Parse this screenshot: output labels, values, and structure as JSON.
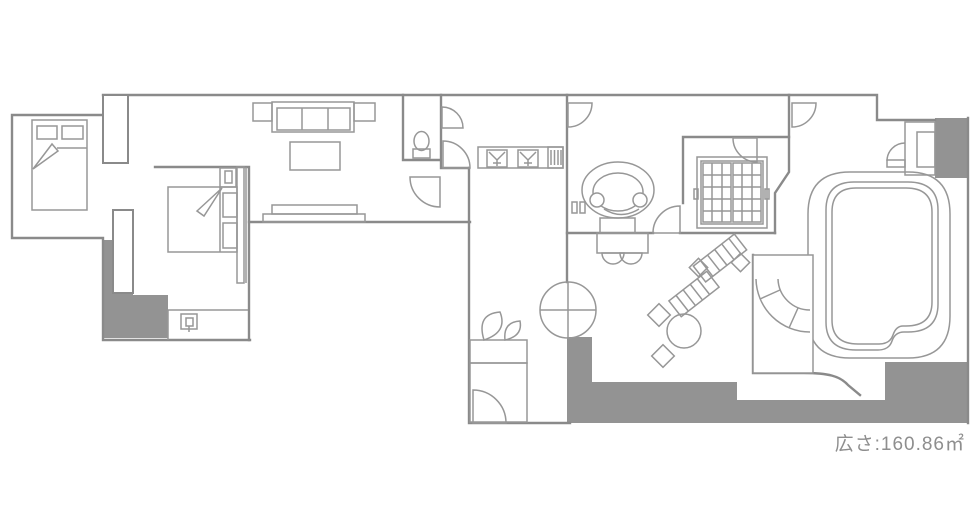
{
  "meta": {
    "kind": "hotel-suite-floor-plan"
  },
  "area_label": {
    "text": "広さ:160.86㎡",
    "prefix": "広さ",
    "value": "160.86",
    "unit": "㎡"
  },
  "colors": {
    "background": "#ffffff",
    "wall_line": "#8a8a8a",
    "furniture_line": "#979797",
    "solid_fill": "#939393",
    "label_text": "#8e8e8e"
  },
  "symbols": [
    "double-bed",
    "double-bed-2",
    "sofa",
    "coffee-table",
    "tv-board",
    "toilet",
    "double-sink-vanity",
    "towel-rack",
    "oval-chair",
    "dressing-desk",
    "desk-chairs",
    "wardrobe-grid",
    "bathtub",
    "curved-steps",
    "entry-plant",
    "shoe-cabinet",
    "lounge-chair",
    "lounge-chair-2",
    "side-table-diamond",
    "round-table",
    "door-swing",
    "double-swing-door",
    "wall-control"
  ]
}
